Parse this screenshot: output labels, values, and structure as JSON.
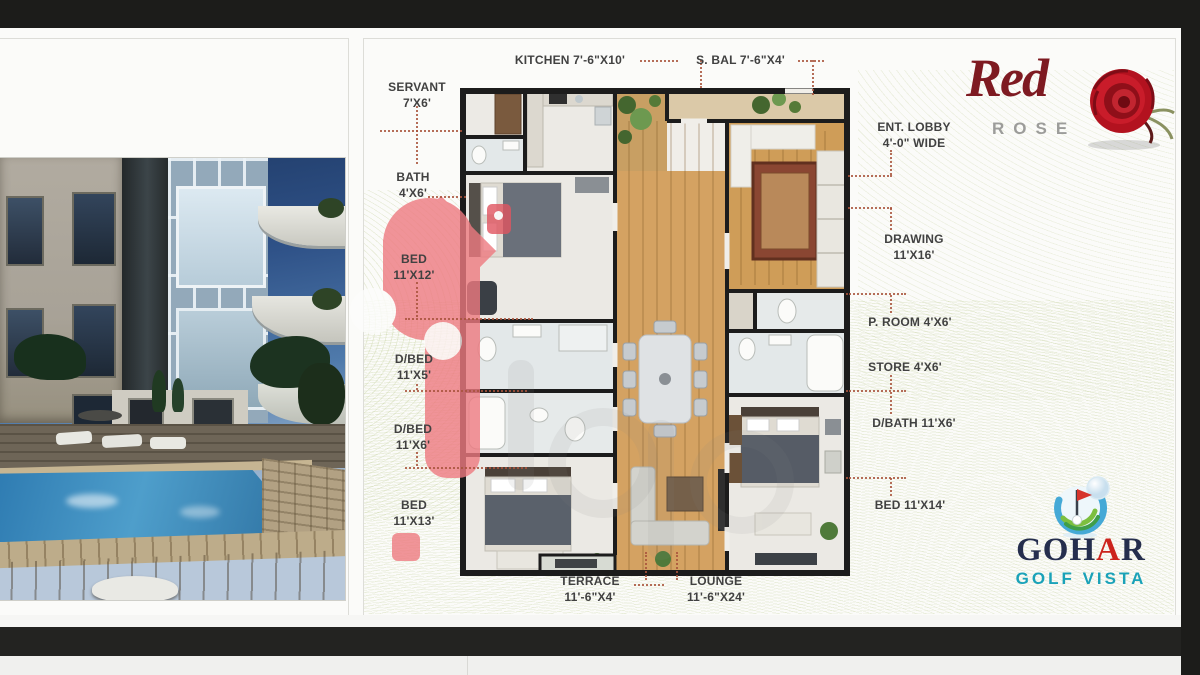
{
  "branding": {
    "red_rose": {
      "script_word": "Red",
      "caps_word": "ROSE"
    },
    "gohar": {
      "name_part1": "GOH",
      "name_part2": "A",
      "name_part3": "R",
      "tagline": "GOLF VISTA"
    }
  },
  "plan_labels": {
    "kitchen": {
      "l1": "KITCHEN 7'-6\"X10'"
    },
    "s_bal": {
      "l1": "S. BAL 7'-6\"X4'"
    },
    "servant": {
      "l1": "SERVANT",
      "l2": "7'X6'"
    },
    "ent_lobby": {
      "l1": "ENT. LOBBY",
      "l2": "4'-0\" WIDE"
    },
    "bath": {
      "l1": "BATH",
      "l2": "4'X6'"
    },
    "drawing": {
      "l1": "DRAWING",
      "l2": "11'X16'"
    },
    "bed1": {
      "l1": "BED",
      "l2": "11'X12'"
    },
    "p_room": {
      "l1": "P. ROOM 4'X6'"
    },
    "dbed1": {
      "l1": "D/BED",
      "l2": "11'X5'"
    },
    "store": {
      "l1": "STORE 4'X6'"
    },
    "dbed2": {
      "l1": "D/BED",
      "l2": "11'X6'"
    },
    "dbath": {
      "l1": "D/BATH 11'X6'"
    },
    "bed2": {
      "l1": "BED",
      "l2": "11'X13'"
    },
    "bed3": {
      "l1": "BED 11'X14'"
    },
    "terrace": {
      "l1": "TERRACE",
      "l2": "11'-6\"X4'"
    },
    "lounge": {
      "l1": "LOUNGE",
      "l2": "11'-6\"X24'"
    }
  },
  "colors": {
    "wall": "#1b1b1b",
    "wood_floor": "#d4a262",
    "leader_dots": "#a8543c",
    "guilloche_green": "#b9cc8a",
    "watermark_pink": "#ee7a80",
    "rose_red": "#7e1a21",
    "rose_gray": "#9c9c9a",
    "gohar_navy": "#252e4d",
    "gohar_red": "#cc241d",
    "gohar_teal": "#1aa2b8"
  }
}
